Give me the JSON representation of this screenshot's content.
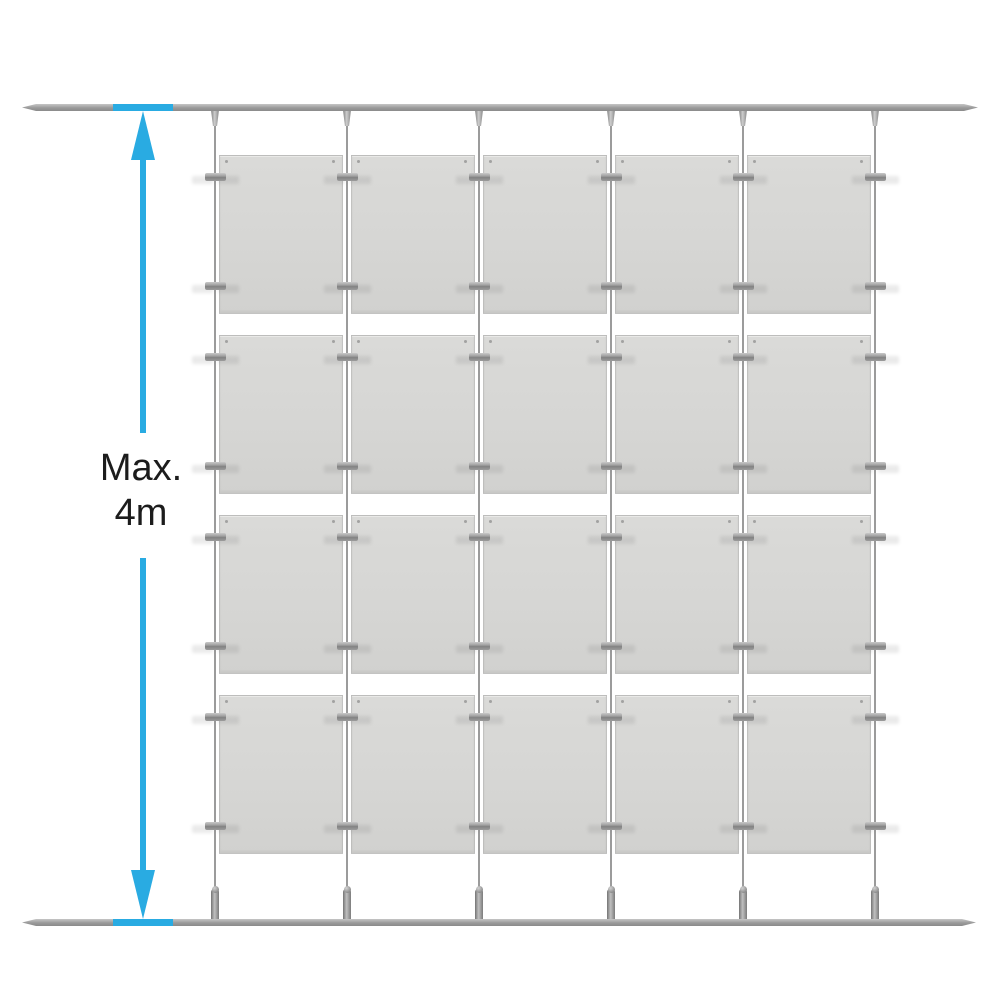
{
  "annotation": {
    "line1": "Max.",
    "line2": "4m"
  },
  "structure": {
    "cables": 6,
    "panel_columns": 5,
    "panel_rows": 4,
    "panels_total": 20,
    "grippers_per_cable_per_row": 2,
    "rails": 2
  },
  "colors": {
    "accent_blue": "#29abe2",
    "rail_gray": "#9a9a9a",
    "cable_gray": "#9b9b9b",
    "panel_gray": "#d6d6d4",
    "fitting_gray": "#8f8f8f",
    "label_text": "#1c1c1c",
    "background": "#ffffff"
  }
}
